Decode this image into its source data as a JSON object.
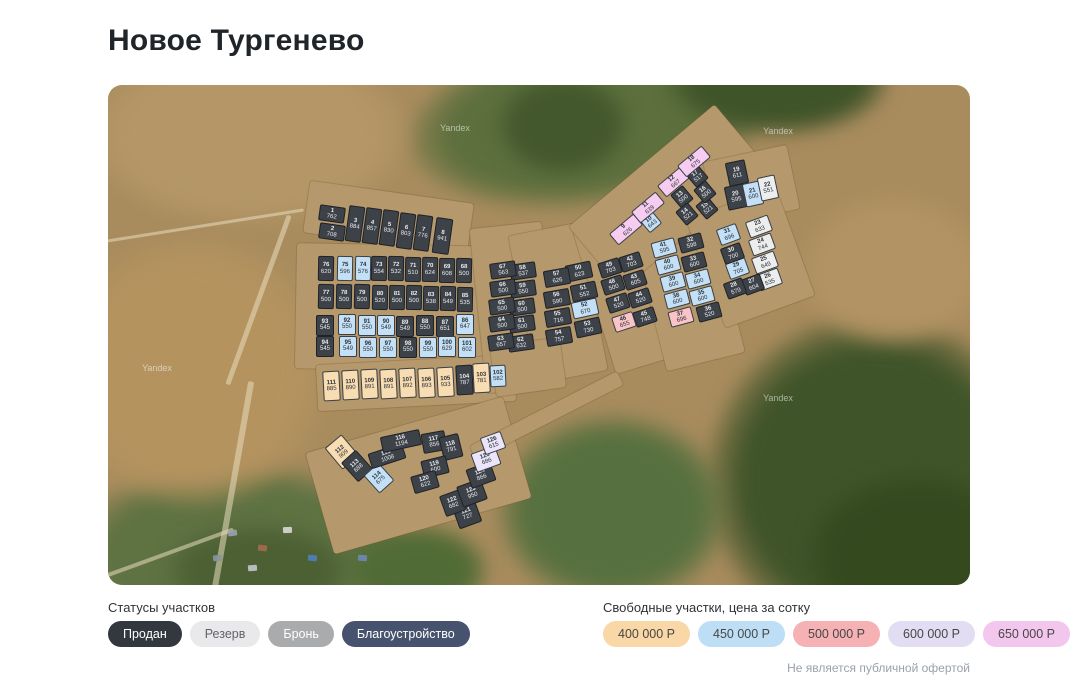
{
  "title": "Новое Тургенево",
  "map": {
    "watermark": "Yandex"
  },
  "status_legend": {
    "title": "Статусы участков",
    "items": [
      {
        "label": "Продан",
        "key": "sold",
        "color": "#33383f"
      },
      {
        "label": "Резерв",
        "key": "reserve",
        "color": "#e9e9eb"
      },
      {
        "label": "Бронь",
        "key": "hold",
        "color": "#a9abad"
      },
      {
        "label": "Благоустройство",
        "key": "improvement",
        "color": "#47536e"
      }
    ]
  },
  "price_legend": {
    "title": "Свободные участки, цена за сотку",
    "items": [
      {
        "label": "400 000 Р",
        "key": "400",
        "color": "#f9d7a6"
      },
      {
        "label": "450 000 Р",
        "key": "450",
        "color": "#bedef6"
      },
      {
        "label": "500 000 Р",
        "key": "500",
        "color": "#f5b1b4"
      },
      {
        "label": "600 000 Р",
        "key": "600",
        "color": "#e2ddf3"
      },
      {
        "label": "650 000 Р",
        "key": "650",
        "color": "#f3c6ee"
      }
    ]
  },
  "disclaimer": "Не является публичной офертой",
  "colors": {
    "s": "#3d4249",
    "rz": "#eceded",
    "400": "#f8dcb2",
    "450": "#c3e0f7",
    "500": "#f9c3c7",
    "600": "#eae5f8",
    "650": "#f6cdf1"
  },
  "plots": [
    [
      1,
      762,
      "s",
      224,
      129,
      26,
      16,
      8
    ],
    [
      2,
      708,
      "s",
      224,
      147,
      26,
      16,
      8
    ],
    [
      3,
      884,
      "s",
      247,
      139,
      16,
      36,
      8
    ],
    [
      4,
      857,
      "s",
      264,
      141,
      16,
      36,
      8
    ],
    [
      5,
      830,
      "s",
      281,
      143,
      16,
      36,
      8
    ],
    [
      6,
      803,
      "s",
      298,
      146,
      16,
      36,
      8
    ],
    [
      7,
      776,
      "s",
      315,
      148,
      16,
      36,
      8
    ],
    [
      8,
      941,
      "s",
      334,
      151,
      17,
      36,
      8
    ],
    [
      9,
      626,
      "650",
      518,
      144,
      32,
      15,
      -40
    ],
    [
      10,
      643,
      "450",
      543,
      137,
      16,
      16,
      -40
    ],
    [
      11,
      639,
      "650",
      540,
      122,
      32,
      15,
      -40
    ],
    [
      12,
      667,
      "650",
      566,
      96,
      32,
      15,
      -40
    ],
    [
      13,
      500,
      "s",
      574,
      112,
      16,
      18,
      -40
    ],
    [
      14,
      521,
      "s",
      579,
      129,
      16,
      18,
      -40
    ],
    [
      15,
      521,
      "s",
      599,
      123,
      16,
      18,
      -40
    ],
    [
      16,
      500,
      "s",
      597,
      107,
      16,
      18,
      -40
    ],
    [
      17,
      517,
      "s",
      589,
      91,
      16,
      18,
      -40
    ],
    [
      18,
      675,
      "650",
      586,
      76,
      32,
      15,
      -40
    ],
    [
      19,
      611,
      "s",
      629,
      88,
      20,
      24,
      -12
    ],
    [
      20,
      595,
      "s",
      628,
      112,
      20,
      24,
      -12
    ],
    [
      21,
      600,
      "450",
      645,
      109,
      18,
      24,
      -12
    ],
    [
      22,
      551,
      "rz",
      660,
      103,
      18,
      24,
      -12
    ],
    [
      23,
      633,
      "rz",
      651,
      141,
      24,
      17,
      -20
    ],
    [
      24,
      744,
      "rz",
      654,
      159,
      24,
      17,
      -20
    ],
    [
      25,
      649,
      "rz",
      657,
      177,
      24,
      17,
      -20
    ],
    [
      26,
      535,
      "rz",
      661,
      194,
      24,
      17,
      -20
    ],
    [
      27,
      604,
      "s",
      645,
      199,
      20,
      17,
      -20
    ],
    [
      28,
      579,
      "s",
      627,
      203,
      20,
      17,
      -20
    ],
    [
      29,
      705,
      "450",
      629,
      183,
      21,
      17,
      -20
    ],
    [
      30,
      700,
      "s",
      624,
      168,
      21,
      17,
      -20
    ],
    [
      31,
      696,
      "450",
      620,
      149,
      21,
      17,
      -20
    ],
    [
      32,
      598,
      "s",
      583,
      158,
      24,
      16,
      -15
    ],
    [
      33,
      600,
      "s",
      586,
      177,
      24,
      16,
      -15
    ],
    [
      34,
      600,
      "450",
      590,
      194,
      24,
      16,
      -15
    ],
    [
      35,
      600,
      "450",
      594,
      211,
      24,
      16,
      -15
    ],
    [
      36,
      520,
      "s",
      601,
      227,
      24,
      16,
      -15
    ],
    [
      37,
      696,
      "500",
      573,
      232,
      24,
      16,
      -15
    ],
    [
      38,
      600,
      "450",
      569,
      214,
      24,
      16,
      -15
    ],
    [
      39,
      600,
      "450",
      565,
      197,
      24,
      16,
      -15
    ],
    [
      40,
      600,
      "450",
      560,
      180,
      24,
      16,
      -15
    ],
    [
      41,
      595,
      "450",
      556,
      163,
      24,
      16,
      -15
    ],
    [
      42,
      703,
      "s",
      523,
      177,
      22,
      16,
      -18
    ],
    [
      43,
      605,
      "s",
      527,
      195,
      22,
      16,
      -18
    ],
    [
      44,
      520,
      "s",
      532,
      213,
      22,
      16,
      -18
    ],
    [
      45,
      748,
      "s",
      537,
      232,
      22,
      16,
      -18
    ],
    [
      46,
      655,
      "500",
      516,
      237,
      22,
      16,
      -18
    ],
    [
      47,
      520,
      "s",
      510,
      218,
      22,
      16,
      -18
    ],
    [
      48,
      500,
      "s",
      505,
      200,
      22,
      16,
      -18
    ],
    [
      49,
      703,
      "s",
      502,
      183,
      22,
      16,
      -18
    ],
    [
      50,
      623,
      "s",
      471,
      186,
      26,
      17,
      -12
    ],
    [
      51,
      552,
      "s",
      476,
      206,
      26,
      17,
      -12
    ],
    [
      52,
      670,
      "450",
      477,
      223,
      26,
      17,
      -12
    ],
    [
      53,
      730,
      "s",
      480,
      242,
      26,
      17,
      -12
    ],
    [
      54,
      757,
      "s",
      451,
      251,
      26,
      17,
      -10
    ],
    [
      55,
      716,
      "s",
      450,
      232,
      26,
      17,
      -10
    ],
    [
      56,
      590,
      "s",
      449,
      213,
      26,
      17,
      -10
    ],
    [
      57,
      626,
      "s",
      449,
      192,
      26,
      17,
      -10
    ],
    [
      58,
      537,
      "s",
      415,
      186,
      26,
      16,
      -8
    ],
    [
      59,
      550,
      "s",
      415,
      204,
      26,
      16,
      -8
    ],
    [
      60,
      500,
      "s",
      414,
      222,
      26,
      16,
      -8
    ],
    [
      61,
      500,
      "s",
      414,
      239,
      26,
      16,
      -8
    ],
    [
      62,
      632,
      "s",
      413,
      258,
      26,
      16,
      -8
    ],
    [
      63,
      657,
      "s",
      393,
      257,
      26,
      16,
      -8
    ],
    [
      64,
      500,
      "s",
      394,
      238,
      26,
      16,
      -8
    ],
    [
      65,
      500,
      "s",
      394,
      221,
      26,
      16,
      -8
    ],
    [
      66,
      500,
      "s",
      395,
      203,
      26,
      16,
      -8
    ],
    [
      67,
      563,
      "s",
      395,
      185,
      26,
      16,
      -8
    ],
    [
      68,
      500,
      "s",
      356,
      185,
      16,
      25,
      1
    ],
    [
      69,
      608,
      "s",
      339,
      185,
      16,
      25,
      1
    ],
    [
      70,
      624,
      "s",
      322,
      184,
      16,
      25,
      1
    ],
    [
      71,
      510,
      "s",
      305,
      184,
      16,
      25,
      1
    ],
    [
      72,
      532,
      "s",
      288,
      183,
      16,
      25,
      1
    ],
    [
      73,
      554,
      "s",
      271,
      183,
      16,
      25,
      1
    ],
    [
      74,
      576,
      "450",
      255,
      183,
      16,
      25,
      1
    ],
    [
      75,
      596,
      "450",
      237,
      183,
      16,
      25,
      1
    ],
    [
      76,
      620,
      "s",
      218,
      183,
      16,
      25,
      1
    ],
    [
      77,
      500,
      "s",
      218,
      211,
      16,
      25,
      1
    ],
    [
      78,
      500,
      "s",
      236,
      211,
      16,
      25,
      1
    ],
    [
      79,
      500,
      "s",
      254,
      211,
      16,
      25,
      1
    ],
    [
      80,
      520,
      "s",
      272,
      212,
      16,
      25,
      1
    ],
    [
      81,
      500,
      "s",
      289,
      212,
      16,
      25,
      1
    ],
    [
      82,
      500,
      "s",
      306,
      212,
      16,
      25,
      1
    ],
    [
      83,
      538,
      "s",
      323,
      213,
      16,
      25,
      1
    ],
    [
      84,
      549,
      "s",
      340,
      213,
      16,
      25,
      1
    ],
    [
      85,
      535,
      "s",
      357,
      214,
      16,
      25,
      1
    ],
    [
      86,
      647,
      "450",
      357,
      239,
      18,
      21,
      0
    ],
    [
      87,
      651,
      "s",
      337,
      241,
      18,
      21,
      0
    ],
    [
      88,
      550,
      "s",
      317,
      240,
      18,
      21,
      0
    ],
    [
      89,
      549,
      "s",
      297,
      241,
      18,
      21,
      0
    ],
    [
      90,
      549,
      "450",
      278,
      240,
      18,
      21,
      0
    ],
    [
      91,
      550,
      "450",
      259,
      240,
      18,
      21,
      0
    ],
    [
      92,
      550,
      "450",
      239,
      239,
      18,
      21,
      0
    ],
    [
      93,
      545,
      "s",
      217,
      240,
      18,
      21,
      0
    ],
    [
      94,
      545,
      "s",
      217,
      261,
      18,
      21,
      0
    ],
    [
      95,
      549,
      "450",
      240,
      261,
      18,
      21,
      0
    ],
    [
      96,
      550,
      "450",
      260,
      262,
      18,
      21,
      0
    ],
    [
      97,
      550,
      "450",
      280,
      262,
      18,
      21,
      0
    ],
    [
      98,
      550,
      "s",
      300,
      262,
      18,
      21,
      0
    ],
    [
      99,
      550,
      "450",
      320,
      262,
      18,
      21,
      0
    ],
    [
      100,
      629,
      "450",
      339,
      261,
      18,
      21,
      0
    ],
    [
      101,
      602,
      "450",
      359,
      262,
      18,
      21,
      0
    ],
    [
      102,
      582,
      "450",
      390,
      291,
      16,
      22,
      -3
    ],
    [
      103,
      781,
      "400",
      373,
      293,
      17,
      30,
      -3
    ],
    [
      104,
      787,
      "s",
      356,
      295,
      17,
      30,
      -3
    ],
    [
      105,
      933,
      "400",
      337,
      297,
      17,
      30,
      -3
    ],
    [
      106,
      893,
      "400",
      318,
      298,
      17,
      30,
      -3
    ],
    [
      107,
      892,
      "400",
      299,
      298,
      17,
      30,
      -3
    ],
    [
      108,
      891,
      "400",
      280,
      299,
      17,
      30,
      -3
    ],
    [
      109,
      891,
      "400",
      261,
      299,
      17,
      30,
      -3
    ],
    [
      110,
      890,
      "400",
      242,
      300,
      17,
      30,
      -3
    ],
    [
      111,
      885,
      "400",
      223,
      301,
      17,
      30,
      -3
    ],
    [
      112,
      909,
      "400",
      234,
      367,
      22,
      28,
      -40
    ],
    [
      113,
      688,
      "s",
      249,
      381,
      20,
      26,
      -42
    ],
    [
      114,
      675,
      "450",
      271,
      393,
      20,
      24,
      -42
    ],
    [
      115,
      1008,
      "s",
      279,
      371,
      36,
      16,
      -18
    ],
    [
      116,
      1194,
      "s",
      293,
      356,
      40,
      16,
      -12
    ],
    [
      117,
      856,
      "s",
      326,
      357,
      24,
      20,
      -10
    ],
    [
      118,
      791,
      "s",
      343,
      362,
      20,
      24,
      -14
    ],
    [
      119,
      600,
      "s",
      327,
      382,
      26,
      18,
      -14
    ],
    [
      120,
      622,
      "s",
      317,
      397,
      26,
      18,
      -16
    ],
    [
      121,
      727,
      "s",
      359,
      429,
      24,
      24,
      -20
    ],
    [
      122,
      682,
      "s",
      345,
      418,
      22,
      22,
      -20
    ],
    [
      123,
      950,
      "s",
      364,
      408,
      26,
      22,
      -20
    ],
    [
      124,
      866,
      "s",
      373,
      390,
      26,
      20,
      -20
    ],
    [
      125,
      686,
      "600",
      378,
      374,
      26,
      20,
      -20
    ],
    [
      126,
      615,
      "600",
      385,
      358,
      22,
      18,
      -20
    ]
  ]
}
